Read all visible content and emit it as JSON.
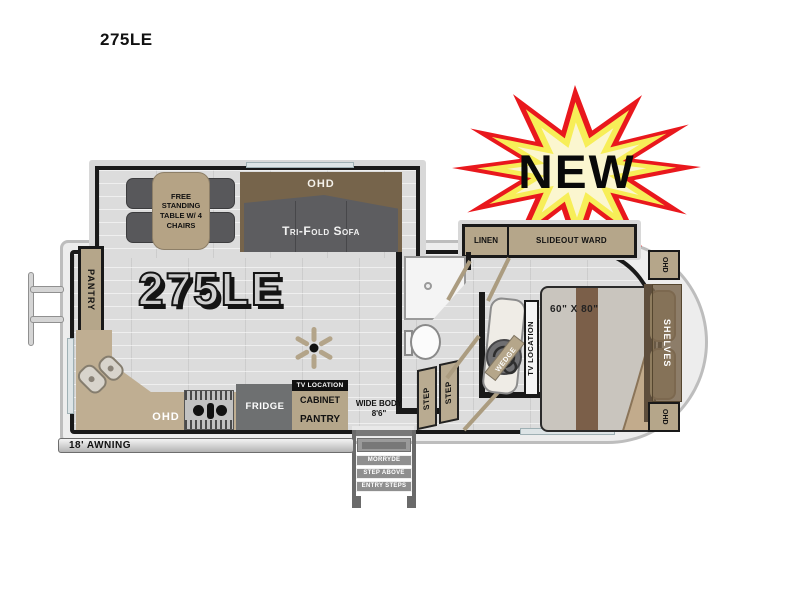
{
  "title": "275LE",
  "badge": {
    "label": "NEW"
  },
  "plan": {
    "model": "275LE",
    "awning_label": "18' AWNING",
    "dinette_label": "FREE STANDING TABLE W/ 4 CHAIRS",
    "sofa_ohd_label": "OHD",
    "sofa_label": "Tri-Fold Sofa",
    "rear_pantry_label": "PANTRY",
    "kitchen": {
      "ohd": "OHD",
      "fridge": "FRIDGE",
      "tv_location": "TV LOCATION",
      "cabinet": "CABINET",
      "pantry": "PANTRY"
    },
    "entry": {
      "wide_body_line1": "WIDE BODY",
      "wide_body_line2": "8'6\"",
      "brand": "MORRYDE",
      "step_above": "STEP ABOVE",
      "entry_steps": "ENTRY STEPS"
    },
    "steps": {
      "lower": "STEP",
      "upper": "STEP"
    },
    "bedroom": {
      "linen": "LINEN",
      "slideout_ward": "SLIDEOUT WARD",
      "bed_size": "60\" X 80\"",
      "wedge": "WEDGE",
      "tv_location": "TV LOCATION",
      "shelves": "SHELVES",
      "ohd_top": "OHD",
      "ohd_bottom": "OHD"
    }
  },
  "colors": {
    "star_red": "#e9181d",
    "star_yellow": "#f7ee58",
    "star_center": "#fbf6cf",
    "tan": "#b5a68a",
    "cabinet_brown": "#76644b",
    "sofa_gray": "#5d5d60",
    "wall_black": "#191919"
  }
}
